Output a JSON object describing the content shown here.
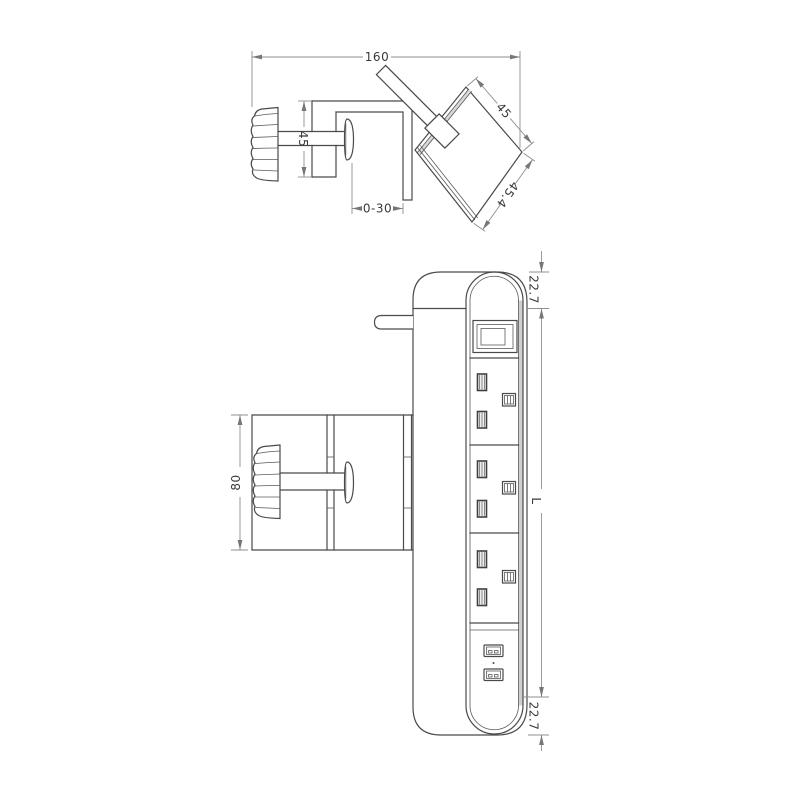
{
  "canvas": {
    "background": "#ffffff",
    "line_color": "#4a4a4a",
    "dim_line_color": "#8f8f8f",
    "text_color": "#3a3a3a",
    "shade_color": "#cfcfcf"
  },
  "drawing": {
    "side_view": {
      "dims": {
        "overall_length": "160",
        "bracket_height": "45",
        "jaw_opening": "0-30",
        "head_width": "45",
        "head_depth": "45.4"
      }
    },
    "front_view": {
      "dims": {
        "clamp_height": "80",
        "top_end_offset": "22.7",
        "body_length": "L",
        "bottom_end_offset": "22.7"
      }
    }
  }
}
